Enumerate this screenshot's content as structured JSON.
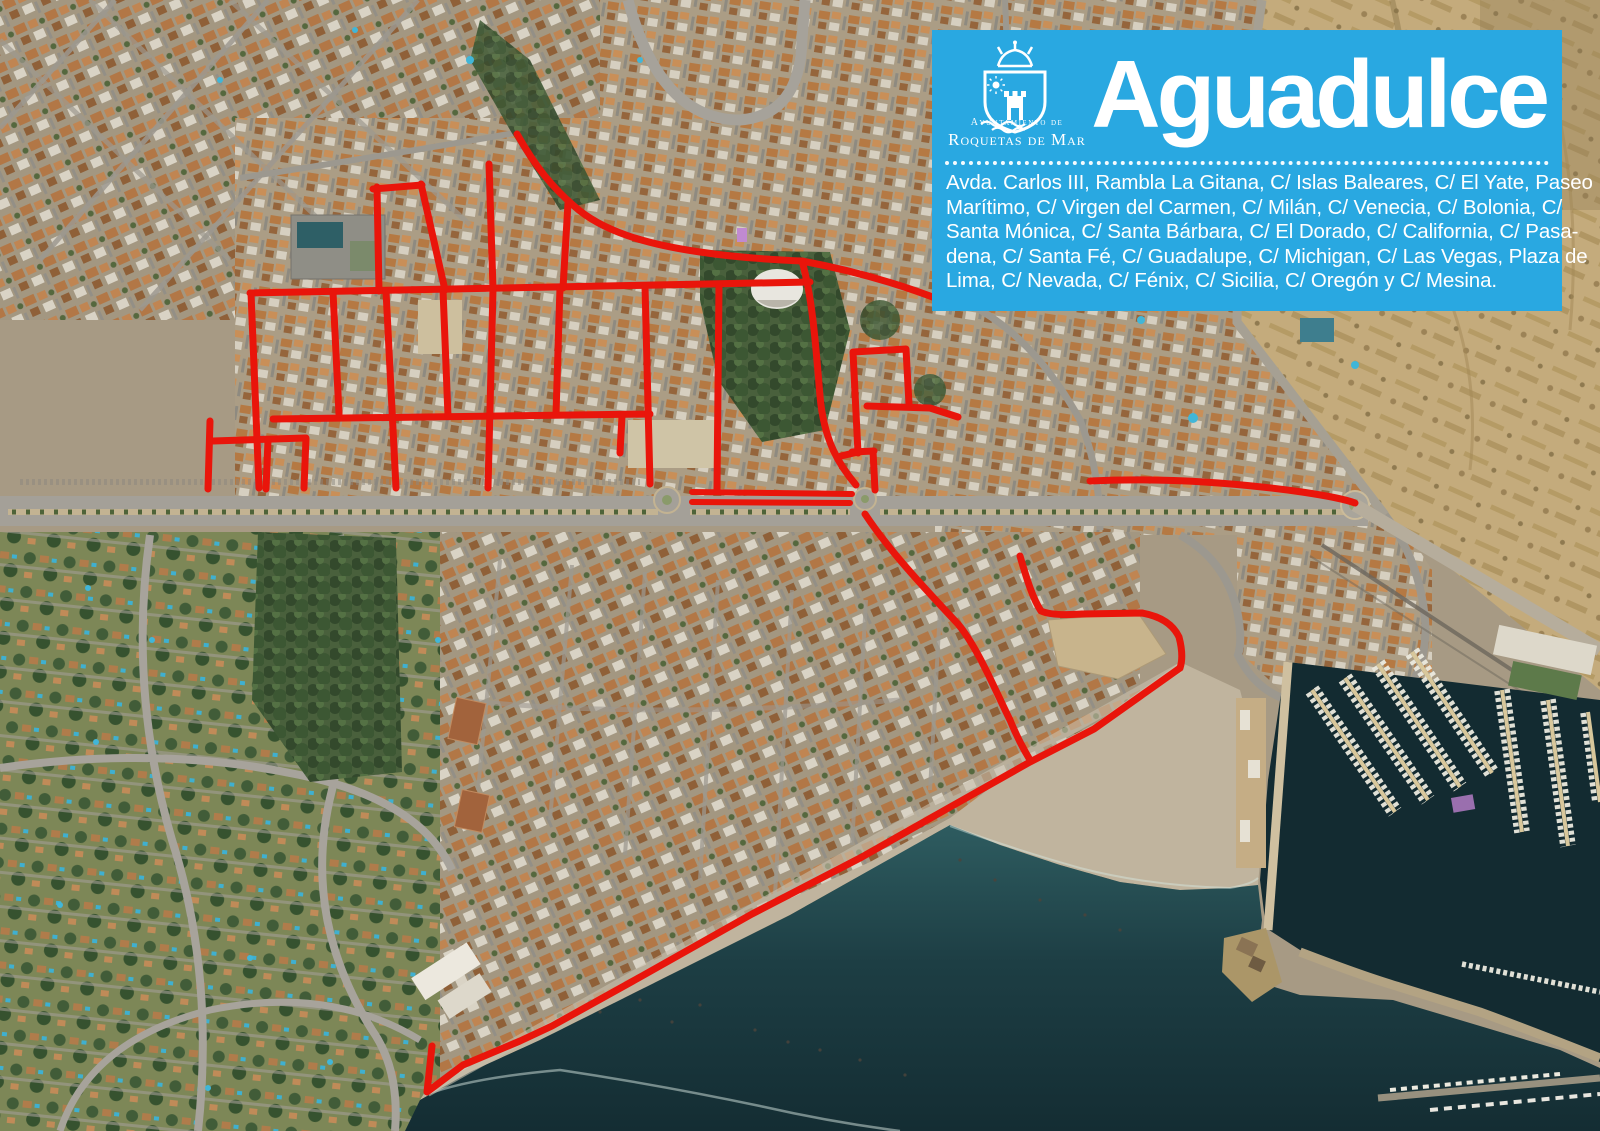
{
  "infobox": {
    "title": "Aguadulce",
    "org_line1": "Ayuntamiento de",
    "org_line2": "Roquetas de Mar",
    "streets_lines": [
      "Avda. Carlos III, Rambla La Gitana, C/ Islas Baleares, C/ El Yate, Paseo",
      "Marítimo,  C/ Virgen del Carmen, C/ Milán, C/ Venecia, C/ Bolonia, C/",
      "Santa Mónica, C/ Santa Bárbara, C/ El Dorado, C/ California, C/ Pasa-",
      "dena, C/ Santa Fé, C/ Guadalupe, C/ Michigan, C/ Las Vegas, Plaza de",
      "Lima, C/ Nevada, C/ Fénix, C/ Sicilia, C/ Oregón y C/ Mesina."
    ],
    "colors": {
      "background_blue": "#29a8e1",
      "text": "#ffffff"
    }
  },
  "map": {
    "type": "satellite-aerial-photo",
    "highlight_route_color": "#e9150b",
    "sea_color": "#1c3a40",
    "sand_color": "#c0b49e",
    "hill_color": "#c4ab7c"
  }
}
